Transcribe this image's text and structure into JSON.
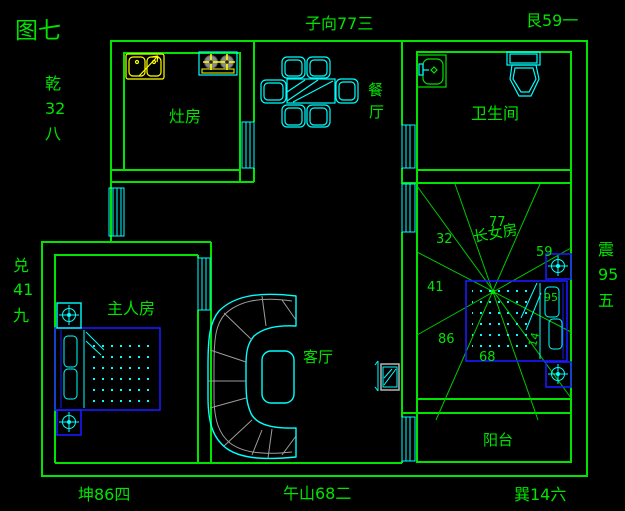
{
  "figure_title": "图七",
  "compass": {
    "top_center": "子向77三",
    "top_right": "艮59一",
    "bottom_left": "坤86四",
    "bottom_center": "午山68二",
    "bottom_right": "巽14六",
    "left_upper": [
      "乾",
      "32",
      "八"
    ],
    "left_lower": [
      "兑",
      "41",
      "九"
    ],
    "right_side": [
      "震",
      "95",
      "五"
    ]
  },
  "rooms": {
    "kitchen": "灶房",
    "dining": [
      "餐",
      "厅"
    ],
    "bathroom": "卫生间",
    "eldest_daughter": "长女房",
    "master": "主人房",
    "living": "客厅",
    "balcony": "阳台"
  },
  "daughter_room_star_numbers": {
    "nw": "32",
    "n": "77",
    "ne": "59",
    "w": "41",
    "e": "95",
    "sw": "86",
    "s": "68",
    "se": "14"
  },
  "colors": {
    "wall_green": "#00e400",
    "furniture_cyan": "#00ffff",
    "bed_blue": "#1a1aff",
    "fixture_yellow": "#ffff00",
    "tv_gray": "#b5b5b5",
    "background": "#000000"
  }
}
